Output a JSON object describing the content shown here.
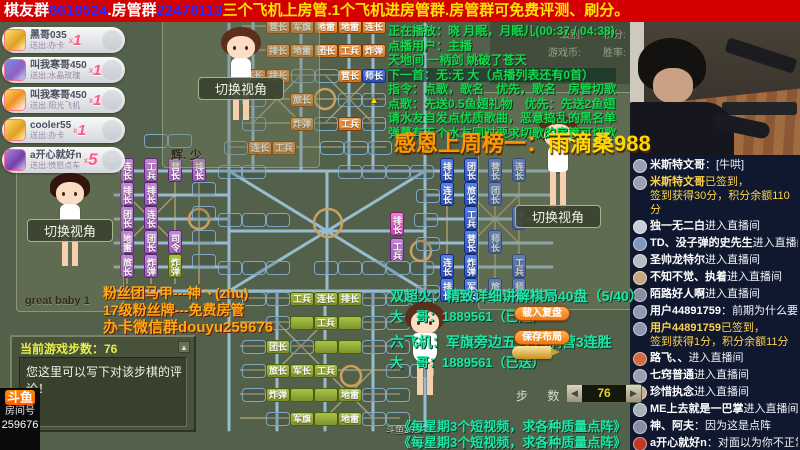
{
  "colors": {
    "banner_bg": "#d40000",
    "accent_teal": "#1fe6a6",
    "accent_yellow": "#ffd800",
    "rail_blue": "#9cc0d8",
    "road_tan": "#bfae7e"
  },
  "banner": {
    "seg1": "棋友群",
    "num1": "8618524",
    "seg2": ".房管群",
    "num2": "22478113",
    "tail": "三个飞机上房管.1个飞机进房管群.房管群可免费评测、刷分。"
  },
  "gifts": [
    {
      "name": "黑哥035",
      "sub": "送出:办卡",
      "x": "x",
      "count": "1",
      "icon": "gi1"
    },
    {
      "name": "叫我寒哥450",
      "sub": "送出:水晶玫瑰",
      "x": "x",
      "count": "1",
      "icon": "gi2"
    },
    {
      "name": "叫我寒哥450",
      "sub": "送出:阳光飞机",
      "x": "x",
      "count": "1",
      "icon": "gi3"
    },
    {
      "name": "cooler55",
      "sub": "送出:办卡",
      "x": "x",
      "count": "1",
      "icon": "gi4"
    },
    {
      "name": "a开心就好n",
      "sub": "送出:愤怒点车",
      "x": "x",
      "count": "5",
      "icon": "gi5"
    }
  ],
  "players": [
    {
      "name": "辉. 少",
      "switch_label": "切换视角"
    },
    {
      "name": "great baby 1",
      "switch_label": "切换视角"
    },
    {
      "name": "123",
      "switch_label": "切换视角"
    },
    {
      "name": "斗鱼259676"
    }
  ],
  "song_info": {
    "lines": [
      "正在播放：晓 月眠，月眠儿(00:37 / 04:38)",
      "点播用户：主播",
      "天地间 一柄剑 姚破了苍天",
      "下一首：无:无 大（点播列表还有0首）",
      "指令：点歌，歌名　优先，歌名　房管切歌",
      "点歌：先送0.5鱼翅礼物　优先：先送2鱼翅",
      "请水友自发点优质歌曲，恶意捣乱的黑名单",
      "弹幕有五个水友同时要求切歌的房管可切歌"
    ]
  },
  "stats": {
    "labels": [
      "级别:",
      "积分:",
      "游戏币:",
      "胜率:"
    ]
  },
  "thanks": {
    "label": "感恩上周榜一：",
    "name": "雨滴桑988"
  },
  "fan_info": {
    "l1": "粉丝团马甲---神丶(zhu)",
    "l2": "17级粉丝牌---免费房管",
    "l3": "办卡微信群douyu259676"
  },
  "promo": {
    "l1": "双超火：精致详细讲解棋局40盘（5/40）",
    "l2": "大　哥：1889561（已送）",
    "l3": "六飞机：军旗旁边五 步内满营3连胜",
    "l4": "大　哥：1889561（已送）",
    "load_btn": "载入复盘",
    "save_btn": "保存布局"
  },
  "video_promo": {
    "line1": "《每星期3个短视频，求各种质量点阵》",
    "line2": "《每星期3个短视频，求各种质量点阵》"
  },
  "steps_panel": {
    "title": "当前游戏步数：76",
    "hint": "您这里可以写下对该步棋的评论！",
    "scroll": "▲"
  },
  "stepper": {
    "label": "步 数",
    "value": "76",
    "dec": "◀",
    "inc": "▶"
  },
  "room": {
    "logo": "斗鱼",
    "label": "房间号",
    "number": "259676"
  },
  "chat": {
    "messages": [
      {
        "type": "chat",
        "u": "米斯特文哥",
        "t": "[牛哄]",
        "av": "#9aa2b2"
      },
      {
        "type": "signin",
        "u": "米斯特文哥",
        "l1": "已签到，",
        "l2": "签到获得30分，积分余额110分",
        "av": "#9aa2b2"
      },
      {
        "type": "enter",
        "u": "独一无二白",
        "t": "进入直播间",
        "av": "#c9cdd6"
      },
      {
        "type": "enter",
        "u": "TD、没子弹的史先生",
        "t": "进入直播间",
        "av": "#7f98c0"
      },
      {
        "type": "enter",
        "u": "圣帅龙特尔",
        "t": "进入直播间",
        "av": "#b8bcc4"
      },
      {
        "type": "enter",
        "u": "不知不觉、执着",
        "t": "进入直播间",
        "av": "#c8a880"
      },
      {
        "type": "enter",
        "u": "陌路好人啊",
        "t": "进入直播间",
        "av": "#8890a0"
      },
      {
        "type": "chat",
        "u": "用户44891759",
        "t": "前期为什么要动最后两行的",
        "av": "#8e98b0"
      },
      {
        "type": "signin",
        "u": "用户44891759",
        "l1": "已签到，",
        "l2": "签到获得1分，积分余额11分",
        "av": "#8e98b0"
      },
      {
        "type": "enter",
        "u": "路飞、、",
        "t": "进入直播间",
        "av": "#d06840"
      },
      {
        "type": "enter",
        "u": "七窍普通",
        "t": "进入直播间",
        "av": "#9aa2b2"
      },
      {
        "type": "enter",
        "u": "珍惜执念",
        "t": "进入直播间",
        "av": "#c8b090"
      },
      {
        "type": "enter",
        "u": "ME上去就是一巴掌",
        "t": "进入直播间",
        "av": "#a8b0b8"
      },
      {
        "type": "chat",
        "u": "神、阿夫",
        "t": "因为这是点阵",
        "av": "#888ea0"
      },
      {
        "type": "chat",
        "u": "a开心就好n",
        "t": "对面以为你不正常，全走五六线",
        "av": "#c03828"
      }
    ]
  },
  "board": {
    "pieces": [
      {
        "t": "营长",
        "x": 266,
        "y": 20,
        "c": "o"
      },
      {
        "t": "军旗",
        "x": 290,
        "y": 20,
        "c": "o"
      },
      {
        "t": "地雷",
        "x": 314,
        "y": 20,
        "c": "o"
      },
      {
        "t": "地雷",
        "x": 338,
        "y": 20,
        "c": "o"
      },
      {
        "t": "连长",
        "x": 362,
        "y": 20,
        "c": "o"
      },
      {
        "t": "排长",
        "x": 266,
        "y": 44,
        "c": "o"
      },
      {
        "t": "地雷",
        "x": 290,
        "y": 44,
        "c": "o"
      },
      {
        "t": "团长",
        "x": 314,
        "y": 44,
        "c": "o"
      },
      {
        "t": "工兵",
        "x": 338,
        "y": 44,
        "c": "o"
      },
      {
        "t": "炸弹",
        "x": 362,
        "y": 44,
        "c": "o"
      },
      {
        "t": "连长",
        "x": 242,
        "y": 69,
        "c": "o"
      },
      {
        "t": "排长",
        "x": 266,
        "y": 69,
        "c": "o"
      },
      {
        "t": "营长",
        "x": 338,
        "y": 69,
        "c": "o"
      },
      {
        "t": "师长",
        "x": 362,
        "y": 69,
        "c": "bu"
      },
      {
        "t": "旅长",
        "x": 290,
        "y": 93,
        "c": "o"
      },
      {
        "t": "炸弹",
        "x": 290,
        "y": 117,
        "c": "o"
      },
      {
        "t": "工兵",
        "x": 338,
        "y": 117,
        "c": "o"
      },
      {
        "t": "连长",
        "x": 248,
        "y": 141,
        "c": "o"
      },
      {
        "t": "工兵",
        "x": 272,
        "y": 141,
        "c": "o"
      },
      {
        "t": "连长",
        "x": 120,
        "y": 158,
        "c": "p",
        "v": 1
      },
      {
        "t": "排长",
        "x": 120,
        "y": 182,
        "c": "p",
        "v": 1
      },
      {
        "t": "团长",
        "x": 120,
        "y": 206,
        "c": "p",
        "v": 1
      },
      {
        "t": "地雷",
        "x": 120,
        "y": 230,
        "c": "p",
        "v": 1
      },
      {
        "t": "旅长",
        "x": 120,
        "y": 254,
        "c": "p",
        "v": 1
      },
      {
        "t": "工兵",
        "x": 144,
        "y": 158,
        "c": "p",
        "v": 1
      },
      {
        "t": "排长",
        "x": 144,
        "y": 182,
        "c": "p",
        "v": 1
      },
      {
        "t": "连长",
        "x": 144,
        "y": 206,
        "c": "p",
        "v": 1
      },
      {
        "t": "团长",
        "x": 144,
        "y": 230,
        "c": "p",
        "v": 1
      },
      {
        "t": "炸弹",
        "x": 144,
        "y": 254,
        "c": "p",
        "v": 1
      },
      {
        "t": "营长",
        "x": 168,
        "y": 158,
        "c": "p",
        "v": 1
      },
      {
        "t": "司令",
        "x": 168,
        "y": 230,
        "c": "p",
        "v": 1
      },
      {
        "t": "炸弹",
        "x": 168,
        "y": 254,
        "c": "g",
        "v": 1
      },
      {
        "t": "排长",
        "x": 192,
        "y": 158,
        "c": "p",
        "v": 1
      },
      {
        "t": "排长",
        "x": 390,
        "y": 212,
        "c": "ph",
        "v": 1
      },
      {
        "t": "工兵",
        "x": 390,
        "y": 238,
        "c": "p",
        "v": 1
      },
      {
        "t": "排长",
        "x": 440,
        "y": 158,
        "c": "b",
        "v": 1
      },
      {
        "t": "连长",
        "x": 440,
        "y": 182,
        "c": "b",
        "v": 1
      },
      {
        "t": "连长",
        "x": 440,
        "y": 254,
        "c": "b",
        "v": 1
      },
      {
        "t": "排长",
        "x": 440,
        "y": 278,
        "c": "b",
        "v": 1
      },
      {
        "t": "团长",
        "x": 464,
        "y": 158,
        "c": "b",
        "v": 1
      },
      {
        "t": "旅长",
        "x": 464,
        "y": 182,
        "c": "b",
        "v": 1
      },
      {
        "t": "工兵",
        "x": 464,
        "y": 206,
        "c": "b",
        "v": 1
      },
      {
        "t": "营长",
        "x": 464,
        "y": 230,
        "c": "b",
        "v": 1
      },
      {
        "t": "炸弹",
        "x": 464,
        "y": 254,
        "c": "b",
        "v": 1
      },
      {
        "t": "军长",
        "x": 464,
        "y": 278,
        "c": "b",
        "v": 1
      },
      {
        "t": "营长",
        "x": 488,
        "y": 158,
        "c": "b",
        "v": 1
      },
      {
        "t": "团长",
        "x": 488,
        "y": 182,
        "c": "b",
        "v": 1
      },
      {
        "t": "师长",
        "x": 488,
        "y": 230,
        "c": "b",
        "v": 1
      },
      {
        "t": "旅长",
        "x": 488,
        "y": 278,
        "c": "b",
        "v": 1
      },
      {
        "t": "连长",
        "x": 512,
        "y": 158,
        "c": "b",
        "v": 1
      },
      {
        "t": "排长",
        "x": 512,
        "y": 206,
        "c": "b",
        "v": 1
      },
      {
        "t": "工兵",
        "x": 512,
        "y": 254,
        "c": "b",
        "v": 1
      },
      {
        "t": "师长",
        "x": 512,
        "y": 278,
        "c": "b",
        "v": 1
      },
      {
        "t": "工兵",
        "x": 290,
        "y": 292,
        "c": "g"
      },
      {
        "t": "连长",
        "x": 314,
        "y": 292,
        "c": "g"
      },
      {
        "t": "排长",
        "x": 338,
        "y": 292,
        "c": "g"
      },
      {
        "t": "",
        "x": 290,
        "y": 316,
        "c": "g"
      },
      {
        "t": "工兵",
        "x": 314,
        "y": 316,
        "c": "g"
      },
      {
        "t": "",
        "x": 338,
        "y": 316,
        "c": "g"
      },
      {
        "t": "团长",
        "x": 266,
        "y": 340,
        "c": "g"
      },
      {
        "t": "",
        "x": 314,
        "y": 340,
        "c": "g"
      },
      {
        "t": "",
        "x": 338,
        "y": 340,
        "c": "g"
      },
      {
        "t": "旅长",
        "x": 266,
        "y": 364,
        "c": "g"
      },
      {
        "t": "军长",
        "x": 290,
        "y": 364,
        "c": "g"
      },
      {
        "t": "工兵",
        "x": 314,
        "y": 364,
        "c": "g"
      },
      {
        "t": "炸弹",
        "x": 266,
        "y": 388,
        "c": "g"
      },
      {
        "t": "",
        "x": 290,
        "y": 388,
        "c": "g"
      },
      {
        "t": "",
        "x": 314,
        "y": 388,
        "c": "g"
      },
      {
        "t": "地雷",
        "x": 338,
        "y": 388,
        "c": "g"
      },
      {
        "t": "军旗",
        "x": 290,
        "y": 412,
        "c": "g"
      },
      {
        "t": "",
        "x": 314,
        "y": 412,
        "c": "g"
      },
      {
        "t": "地雷",
        "x": 338,
        "y": 412,
        "c": "g"
      },
      {
        "t": "",
        "x": 291,
        "y": 69,
        "c": "e"
      },
      {
        "t": "",
        "x": 315,
        "y": 69,
        "c": "e"
      },
      {
        "t": "",
        "x": 242,
        "y": 93,
        "c": "e"
      },
      {
        "t": "",
        "x": 338,
        "y": 93,
        "c": "e"
      },
      {
        "t": "▲",
        "x": 362,
        "y": 93,
        "c": "e",
        "a": 1
      },
      {
        "t": "",
        "x": 242,
        "y": 117,
        "c": "e"
      },
      {
        "t": "",
        "x": 314,
        "y": 117,
        "c": "e"
      },
      {
        "t": "",
        "x": 362,
        "y": 117,
        "c": "e"
      },
      {
        "t": "",
        "x": 224,
        "y": 141,
        "c": "e"
      },
      {
        "t": "",
        "x": 320,
        "y": 141,
        "c": "e"
      },
      {
        "t": "",
        "x": 344,
        "y": 141,
        "c": "e"
      },
      {
        "t": "",
        "x": 368,
        "y": 141,
        "c": "e"
      },
      {
        "t": "",
        "x": 144,
        "y": 134,
        "c": "e"
      },
      {
        "t": "",
        "x": 168,
        "y": 134,
        "c": "e"
      },
      {
        "t": "",
        "x": 218,
        "y": 165,
        "c": "e"
      },
      {
        "t": "",
        "x": 242,
        "y": 165,
        "c": "e"
      },
      {
        "t": "",
        "x": 338,
        "y": 165,
        "c": "e"
      },
      {
        "t": "",
        "x": 362,
        "y": 165,
        "c": "e"
      },
      {
        "t": "",
        "x": 386,
        "y": 165,
        "c": "e"
      },
      {
        "t": "",
        "x": 410,
        "y": 165,
        "c": "e"
      },
      {
        "t": "",
        "x": 218,
        "y": 213,
        "c": "e"
      },
      {
        "t": "",
        "x": 242,
        "y": 213,
        "c": "e"
      },
      {
        "t": "",
        "x": 266,
        "y": 213,
        "c": "e"
      },
      {
        "t": "",
        "x": 414,
        "y": 213,
        "c": "e"
      },
      {
        "t": "",
        "x": 218,
        "y": 261,
        "c": "e"
      },
      {
        "t": "",
        "x": 242,
        "y": 261,
        "c": "e"
      },
      {
        "t": "",
        "x": 266,
        "y": 261,
        "c": "e"
      },
      {
        "t": "",
        "x": 314,
        "y": 261,
        "c": "e"
      },
      {
        "t": "",
        "x": 338,
        "y": 261,
        "c": "e"
      },
      {
        "t": "",
        "x": 362,
        "y": 261,
        "c": "e"
      },
      {
        "t": "",
        "x": 386,
        "y": 261,
        "c": "e"
      },
      {
        "t": "",
        "x": 410,
        "y": 261,
        "c": "e"
      },
      {
        "t": "",
        "x": 192,
        "y": 182,
        "c": "e"
      },
      {
        "t": "",
        "x": 192,
        "y": 206,
        "c": "e"
      },
      {
        "t": "",
        "x": 192,
        "y": 230,
        "c": "e"
      },
      {
        "t": "",
        "x": 192,
        "y": 254,
        "c": "e"
      },
      {
        "t": "",
        "x": 416,
        "y": 189,
        "c": "e"
      },
      {
        "t": "",
        "x": 416,
        "y": 237,
        "c": "e"
      },
      {
        "t": "",
        "x": 416,
        "y": 285,
        "c": "e"
      },
      {
        "t": "",
        "x": 242,
        "y": 292,
        "c": "e"
      },
      {
        "t": "",
        "x": 266,
        "y": 292,
        "c": "e"
      },
      {
        "t": "",
        "x": 362,
        "y": 292,
        "c": "e"
      },
      {
        "t": "",
        "x": 386,
        "y": 292,
        "c": "e"
      },
      {
        "t": "",
        "x": 410,
        "y": 292,
        "c": "e"
      },
      {
        "t": "",
        "x": 266,
        "y": 316,
        "c": "e"
      },
      {
        "t": "",
        "x": 362,
        "y": 316,
        "c": "e"
      },
      {
        "t": "",
        "x": 386,
        "y": 316,
        "c": "e"
      },
      {
        "t": "",
        "x": 242,
        "y": 340,
        "c": "e"
      },
      {
        "t": "",
        "x": 290,
        "y": 340,
        "c": "e"
      },
      {
        "t": "",
        "x": 362,
        "y": 340,
        "c": "e"
      },
      {
        "t": "",
        "x": 386,
        "y": 340,
        "c": "e"
      },
      {
        "t": "",
        "x": 242,
        "y": 364,
        "c": "e"
      },
      {
        "t": "",
        "x": 386,
        "y": 364,
        "c": "e"
      },
      {
        "t": "",
        "x": 410,
        "y": 364,
        "c": "e"
      },
      {
        "t": "",
        "x": 242,
        "y": 388,
        "c": "e"
      },
      {
        "t": "",
        "x": 362,
        "y": 388,
        "c": "e"
      },
      {
        "t": "",
        "x": 386,
        "y": 388,
        "c": "e"
      },
      {
        "t": "",
        "x": 266,
        "y": 412,
        "c": "e"
      },
      {
        "t": "",
        "x": 362,
        "y": 412,
        "c": "e"
      },
      {
        "t": "",
        "x": 386,
        "y": 412,
        "c": "e"
      }
    ]
  }
}
